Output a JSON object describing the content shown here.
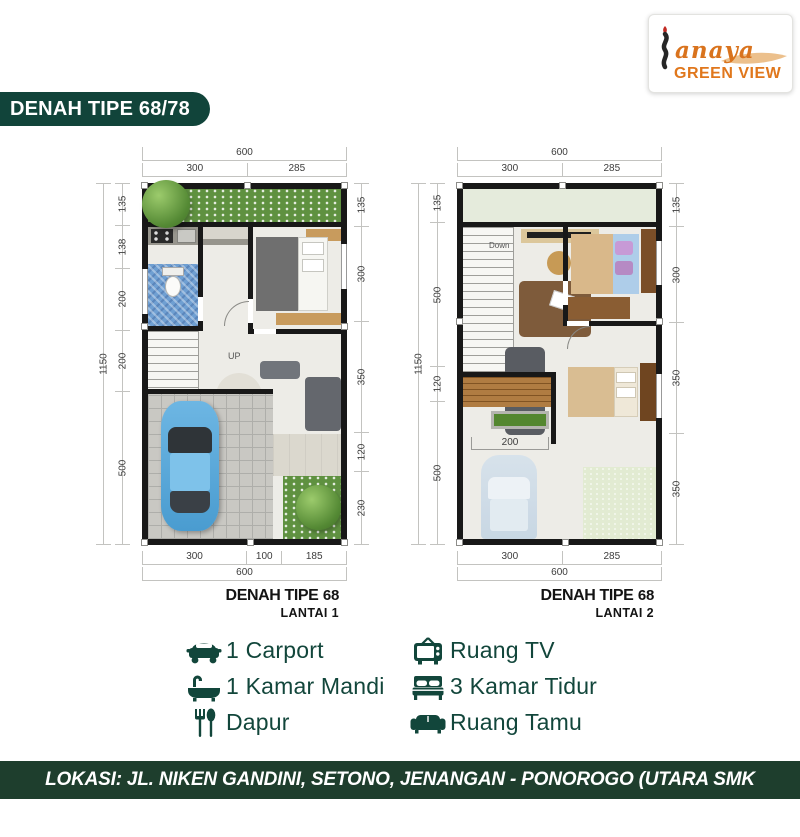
{
  "logo": {
    "script": "anaya",
    "name": "GREEN VIEW"
  },
  "header": {
    "title": "DENAH TIPE 68/78"
  },
  "plan1": {
    "title": "DENAH TIPE",
    "title_num": "68",
    "subtitle": "LANTAI 1",
    "stairs_label": "UP",
    "dims": {
      "top_total": "600",
      "top_a": "300",
      "top_b": "285",
      "left_total": "1150",
      "l1": "135",
      "l2": "138",
      "l3": "200",
      "l4": "200",
      "l5": "500",
      "r1": "135",
      "r2": "300",
      "r3": "350",
      "r4": "120",
      "r5": "230",
      "b1": "300",
      "b2": "100",
      "b3": "185",
      "bottom_total": "600"
    }
  },
  "plan2": {
    "title": "DENAH TIPE",
    "title_num": "68",
    "subtitle": "LANTAI 2",
    "stairs_label": "Down",
    "dims": {
      "top_total": "600",
      "top_a": "300",
      "top_b": "285",
      "left_total": "1150",
      "l1": "135",
      "l2": "500",
      "l3": "120",
      "l4": "500",
      "r1": "135",
      "r2": "300",
      "r3": "350",
      "r4": "350",
      "b1": "300",
      "b2": "285",
      "bottom_total": "600",
      "deck": "200"
    }
  },
  "legend": {
    "items_left": [
      {
        "icon": "car-icon",
        "label": "1 Carport"
      },
      {
        "icon": "bathtub-icon",
        "label": "1 Kamar Mandi"
      },
      {
        "icon": "utensils-icon",
        "label": "Dapur"
      }
    ],
    "items_right": [
      {
        "icon": "tv-icon",
        "label": "Ruang TV"
      },
      {
        "icon": "bed-icon",
        "label": "3 Kamar Tidur"
      },
      {
        "icon": "sofa-icon",
        "label": "Ruang Tamu"
      }
    ]
  },
  "footer": {
    "location": "LOKASI: JL. NIKEN GANDINI, SETONO, JENANGAN - PONOROGO (UTARA SMK PEMKAB)"
  },
  "colors": {
    "banner_green": "#11443a",
    "footer_green": "#1e3e2d",
    "legend_green": "#12463b",
    "brand_orange": "#e0771c",
    "swoosh_tan": "#ecc08c",
    "car_blue": "#5fabd9",
    "tile_blue": "#6f9fd2"
  }
}
